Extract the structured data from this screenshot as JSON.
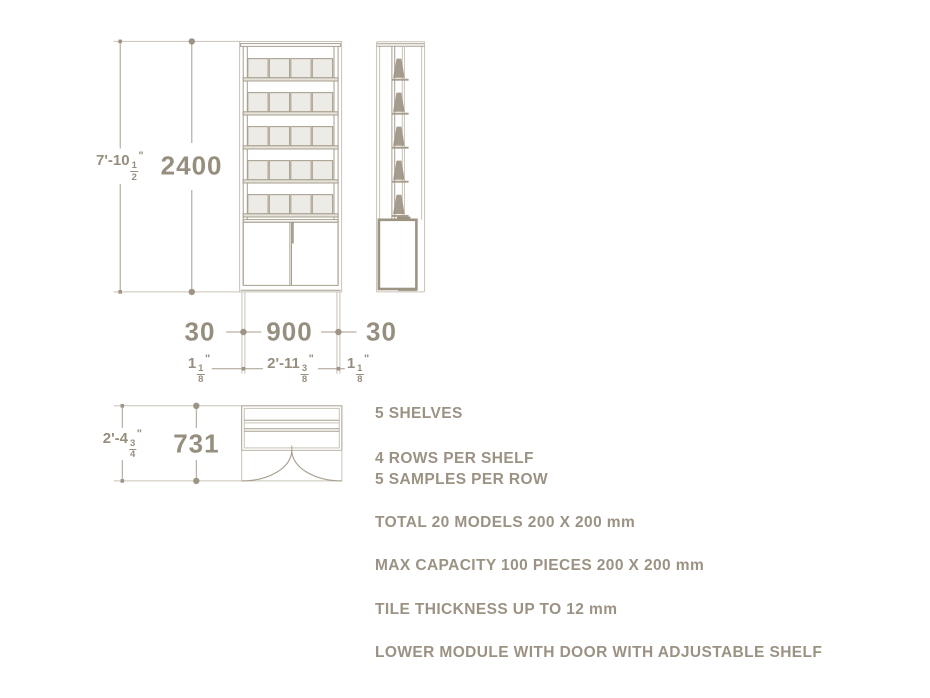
{
  "dimensions": {
    "height_mm": "2400",
    "height_ft": {
      "whole": "7'-10",
      "num": "1",
      "den": "2",
      "unit": "\""
    },
    "frame_left_mm": "30",
    "width_mm": "900",
    "frame_right_mm": "30",
    "frame_left_ft": {
      "whole": "1",
      "num": "1",
      "den": "8",
      "unit": "\""
    },
    "width_ft": {
      "whole": "2'-11",
      "num": "3",
      "den": "8",
      "unit": "\""
    },
    "frame_right_ft": {
      "whole": "1",
      "num": "1",
      "den": "8",
      "unit": "\""
    },
    "depth_mm": "731",
    "depth_ft": {
      "whole": "2'-4",
      "num": "3",
      "den": "4",
      "unit": "\""
    }
  },
  "notes": [
    "5 SHELVES",
    "4 ROWS PER SHELF",
    "5 SAMPLES PER ROW",
    "TOTAL 20 MODELS 200 X 200 mm",
    "MAX CAPACITY 100 PIECES 200 X 200 mm",
    "TILE THICKNESS UP TO 12 mm",
    "LOWER MODULE WITH DOOR WITH ADJUSTABLE SHELF"
  ],
  "colors": {
    "line": "#a79e8e",
    "line_light": "#c9c3b7",
    "line_dark": "#9d9484",
    "tile_fill": "#edebe6",
    "tile_stroke": "#aba291",
    "dim_text": "#968e7e",
    "note_text": "#9b9284"
  }
}
